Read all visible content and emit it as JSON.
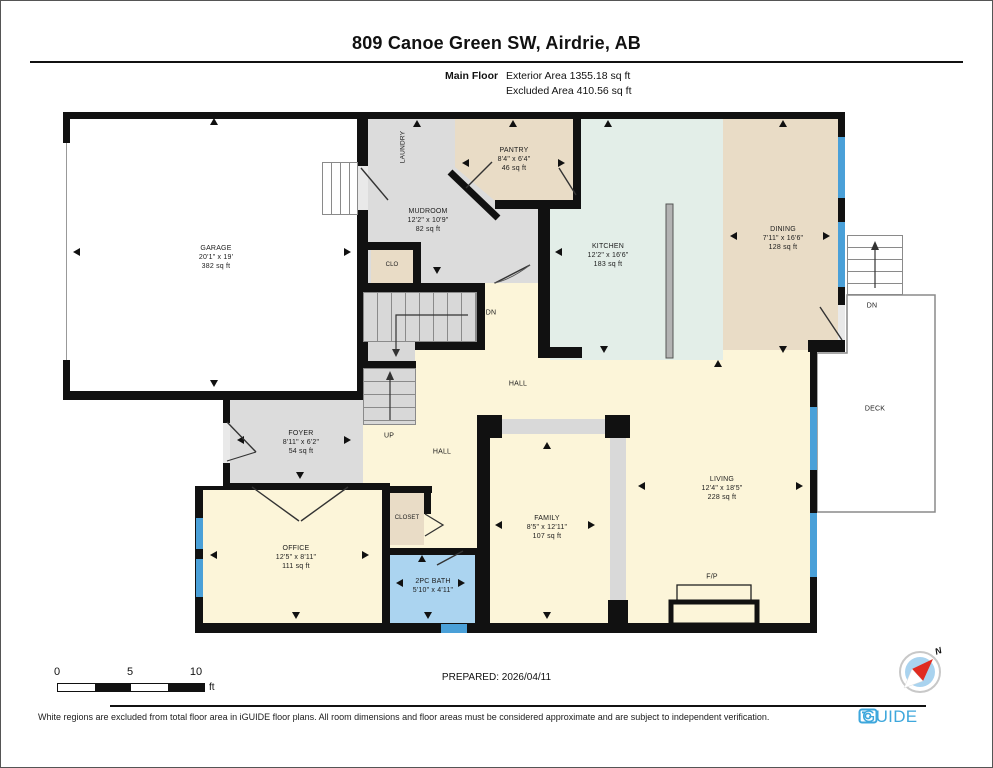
{
  "header": {
    "title": "809 Canoe Green SW, Airdrie, AB",
    "floor_label": "Main Floor",
    "exterior_area": "Exterior Area 1355.18 sq ft",
    "excluded_area": "Excluded Area 410.56 sq ft"
  },
  "rooms": [
    {
      "name": "GARAGE",
      "dims": "20'1\" x 19'",
      "area": "382 sq ft"
    },
    {
      "name": "MUDROOM",
      "dims": "12'2\" x 10'9\"",
      "area": "82 sq ft"
    },
    {
      "name": "PANTRY",
      "dims": "8'4\" x 6'4\"",
      "area": "46 sq ft"
    },
    {
      "name": "KITCHEN",
      "dims": "12'2\" x 16'6\"",
      "area": "183 sq ft"
    },
    {
      "name": "DINING",
      "dims": "7'11\" x 16'6\"",
      "area": "128 sq ft"
    },
    {
      "name": "LIVING",
      "dims": "12'4\" x 18'5\"",
      "area": "228 sq ft"
    },
    {
      "name": "FAMILY",
      "dims": "8'5\" x 12'11\"",
      "area": "107 sq ft"
    },
    {
      "name": "OFFICE",
      "dims": "12'5\" x 8'11\"",
      "area": "111 sq ft"
    },
    {
      "name": "FOYER",
      "dims": "8'11\" x 6'2\"",
      "area": "54 sq ft"
    },
    {
      "name": "2PC BATH",
      "dims": "5'10\" x 4'11\"",
      "area": ""
    }
  ],
  "labels": {
    "laundry": "LAUNDRY",
    "clo": "CLO",
    "closet": "CLOSET",
    "hall_upper": "HALL",
    "hall_lower": "HALL",
    "deck": "DECK",
    "fireplace": "F/P",
    "up": "UP",
    "dn": "DN",
    "deck_dn": "DN",
    "north": "N"
  },
  "scale_bar": {
    "start": "0",
    "mid": "5",
    "end": "10",
    "unit": "ft"
  },
  "prepared": "PREPARED: 2026/04/11",
  "footer": {
    "disclaimer": "White regions are excluded from total floor area in iGUIDE floor plans. All room dimensions and floor areas must be considered approximate and are subject to independent verification.",
    "brand": "iGUIDE"
  },
  "colors": {
    "walls": "#111111",
    "kitchen": "#e3eee8",
    "tan": "#e9dcc6",
    "gray": "#dcdcdc",
    "cream": "#fcf5d9",
    "bath": "#abd4f0",
    "window": "#4aa0d8",
    "stairs": "#d8d8d8",
    "brand": "#3ea7dc"
  }
}
